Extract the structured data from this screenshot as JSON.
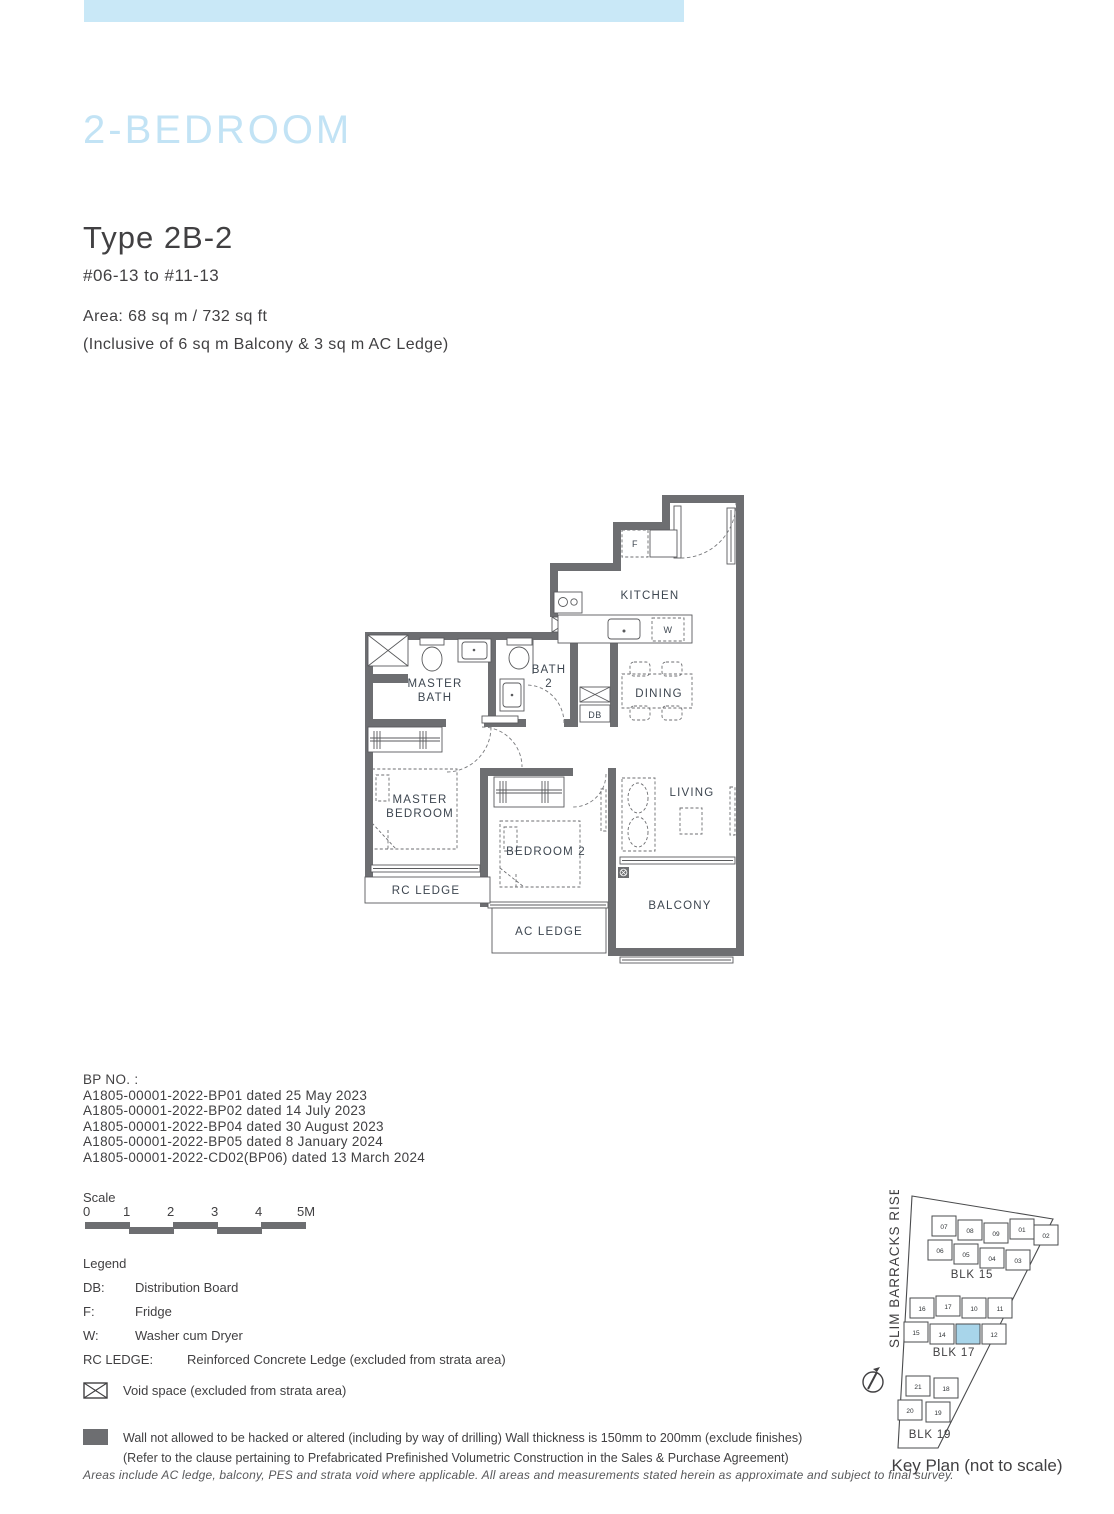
{
  "page": {
    "category_title": "2-BEDROOM",
    "type_title": "Type 2B-2",
    "unit_range": "#06-13 to #11-13",
    "area_line1": "Area: 68 sq m / 732 sq ft",
    "area_line2": "(Inclusive of 6 sq m Balcony & 3 sq m AC Ledge)"
  },
  "colors": {
    "top_bar_blue": "#c9e8f7",
    "heading_blue": "#c2e3f5",
    "wall_gray": "#6d6e71",
    "text_dark": "#414042",
    "plan_label": "#3d4650",
    "keyplan_highlight_blue": "#a8d5ea"
  },
  "floorplan": {
    "labels": {
      "kitchen": "KITCHEN",
      "master_bath_l1": "MASTER",
      "master_bath_l2": "BATH",
      "bath2_l1": "BATH",
      "bath2_l2": "2",
      "db": "DB",
      "dining": "DINING",
      "living": "LIVING",
      "master_bedroom_l1": "MASTER",
      "master_bedroom_l2": "BEDROOM",
      "bedroom2": "BEDROOM 2",
      "rc_ledge": "RC LEDGE",
      "ac_ledge": "AC LEDGE",
      "balcony": "BALCONY",
      "fridge": "F",
      "washer": "W"
    }
  },
  "bp": {
    "heading": "BP NO. :",
    "items": [
      "A1805-00001-2022-BP01 dated 25 May 2023",
      "A1805-00001-2022-BP02 dated 14 July 2023",
      "A1805-00001-2022-BP04 dated 30 August 2023",
      "A1805-00001-2022-BP05 dated 8 January 2024",
      "A1805-00001-2022-CD02(BP06) dated 13 March 2024"
    ]
  },
  "scale": {
    "label": "Scale",
    "ticks": [
      "0",
      "1",
      "2",
      "3",
      "4",
      "5M"
    ]
  },
  "legend": {
    "heading": "Legend",
    "items": [
      {
        "key": "DB:",
        "value": "Distribution Board"
      },
      {
        "key": "F:",
        "value": "Fridge"
      },
      {
        "key": "W:",
        "value": "Washer cum Dryer"
      },
      {
        "key": "RC LEDGE:",
        "value": "Reinforced Concrete Ledge (excluded from strata area)"
      }
    ],
    "void_note": "Void space (excluded from strata area)",
    "wall_note_line1": "Wall not allowed to be hacked or altered (including by way of drilling) Wall thickness is 150mm to 200mm (exclude finishes)",
    "wall_note_line2": "(Refer to the clause pertaining to Prefabricated Prefinished Volumetric Construction in the Sales & Purchase Agreement)"
  },
  "footer": {
    "disclaimer": "Areas include AC ledge, balcony, PES and strata void where applicable. All areas and measurements stated herein as approximate and subject to final survey."
  },
  "keyplan": {
    "street": "SLIM BARRACKS RISE",
    "caption": "Key Plan (not to scale)",
    "blocks": [
      {
        "label": "BLK 15",
        "rows": [
          [
            "07",
            "08",
            "09",
            "01",
            "02"
          ],
          [
            "06",
            "05",
            "04",
            "03"
          ]
        ]
      },
      {
        "label": "BLK 17",
        "rows": [
          [
            "16",
            "17",
            "10",
            "11"
          ],
          [
            "15",
            "14",
            "",
            "12"
          ]
        ]
      },
      {
        "label": "BLK 19",
        "rows": [
          [
            "21",
            "18"
          ],
          [
            "20",
            "19"
          ]
        ]
      }
    ]
  }
}
